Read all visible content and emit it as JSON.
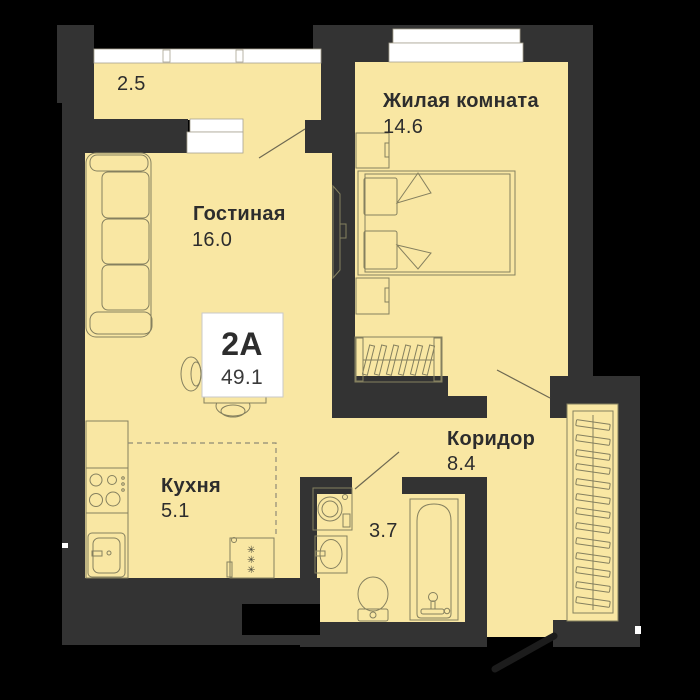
{
  "unit_card": {
    "type": "2А",
    "area": "49.1"
  },
  "rooms": {
    "balcony": {
      "area": "2.5"
    },
    "bedroom": {
      "name": "Жилая комната",
      "area": "14.6"
    },
    "living": {
      "name": "Гостиная",
      "area": "16.0"
    },
    "kitchen": {
      "name": "Кухня",
      "area": "5.1"
    },
    "corridor": {
      "name": "Коридор",
      "area": "8.4"
    },
    "bathroom": {
      "area": "3.7"
    }
  },
  "icons": {
    "snowflake": "✳"
  },
  "colors": {
    "floor": "#F9E7A3",
    "wall": "#333333",
    "background": "#000000",
    "furniture_outline": "#85805F",
    "text": "#2D2D2D",
    "window_white": "#FFFFFF"
  }
}
